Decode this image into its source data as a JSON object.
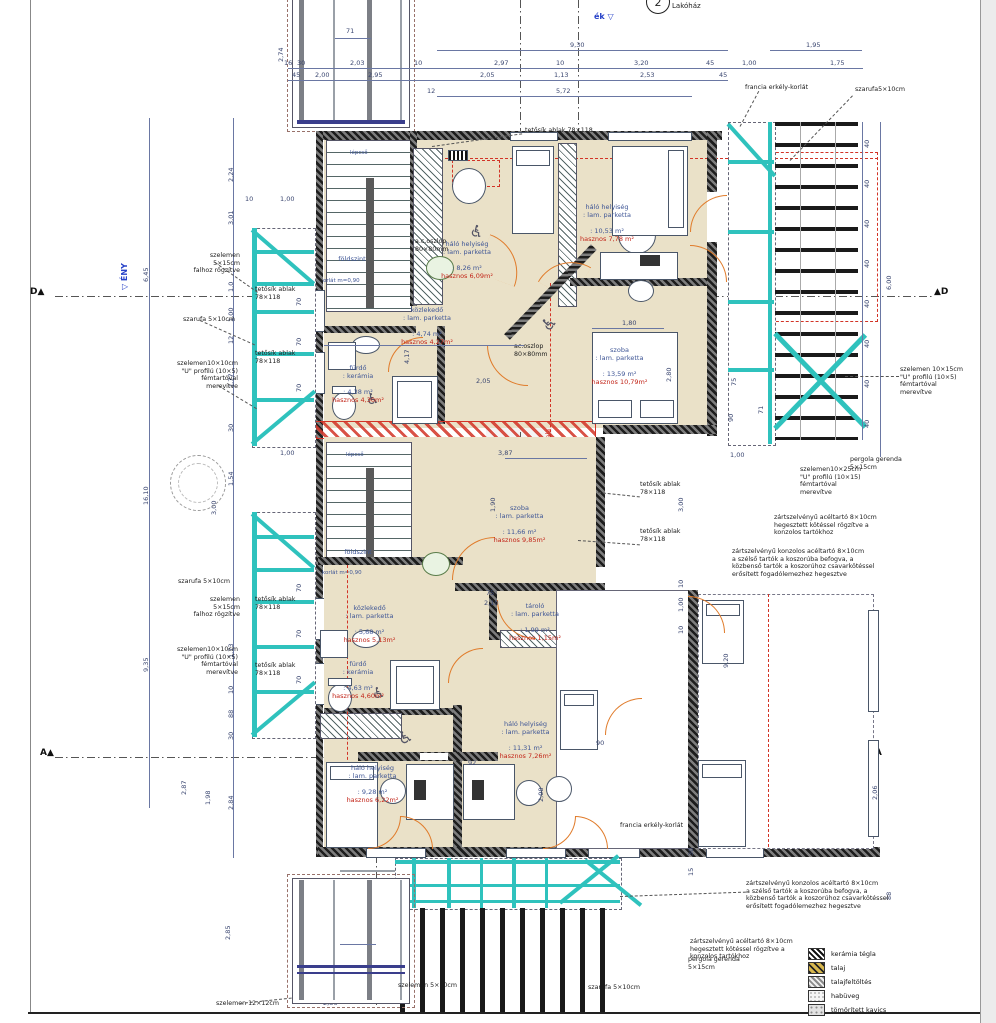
{
  "markers": {
    "unit1_num": "1",
    "unit1_label": "Lakóház",
    "unit2_num": "2",
    "unit2_label": "Lakóház",
    "dir_top": "ék",
    "dir_top_tri": "▽",
    "dir_left": "▽ ÉNY",
    "dir_right": "▽ DK",
    "north_letter": "É",
    "sec_d_left": "D▲",
    "sec_d_right": "▲D",
    "sec_a_left": "A▲",
    "sec_a_right": "▲A"
  },
  "rooms": [
    {
      "name": "háló helyiség",
      "floor": ": lam. parketta",
      "area": ": 8,26 m²",
      "useful": "hasznos 6,09m²"
    },
    {
      "name": "háló helyiség",
      "floor": ": lam. parketta",
      "area": ": 10,53 m²",
      "useful": "hasznos 7,78 m²"
    },
    {
      "name": "közlekedő",
      "floor": ": lam. parketta",
      "area": ": 4,74 m²",
      "useful": "hasznos 4,27m²"
    },
    {
      "name": "szoba",
      "floor": ": lam. parketta",
      "area": ": 13,59 m²",
      "useful": "hasznos 10,79m²"
    },
    {
      "name": "fürdő",
      "floor": ": kerámia",
      "area": ": 4,38 m²",
      "useful": "hasznos 4,30m²"
    },
    {
      "name": "szoba",
      "floor": ": lam. parketta",
      "area": ": 11,66 m²",
      "useful": "hasznos 9,85m²"
    },
    {
      "name": "közlekedő",
      "floor": ": lam. parketta",
      "area": ": 5,68 m²",
      "useful": "hasznos 5,13m²"
    },
    {
      "name": "tároló",
      "floor": ": lam. parketta",
      "area": ": 1,99 m²",
      "useful": "hasznos 1,15m²"
    },
    {
      "name": "fürdő",
      "floor": ": kerámia",
      "area": ": 4,63 m²",
      "useful": "hasznos 4,60m²"
    },
    {
      "name": "háló helyiség",
      "floor": ": lam. parketta",
      "area": ": 11,31 m²",
      "useful": "hasznos 7,26m²"
    },
    {
      "name": "háló helyiség",
      "floor": ": lam. parketta",
      "area": ": 9,28 m²",
      "useful": "hasznos 6,22m²"
    }
  ],
  "stairs": {
    "label": "lépcső",
    "floor_ref": "földszint",
    "rail": "korlát m=0,90"
  },
  "annotations": {
    "szelemen515": "szelemen\n5×15cm\nfalhoz rögzítve",
    "szarufa510": "szarufa 5×10cm",
    "szarufa510b": "szarufa5×10cm",
    "tetosik": "tetősík ablak\n78×118",
    "tetosik_inline": "tetősík ablak 78×118",
    "szelemen1010": "szelemen10×10cm\n\"U\" profilú (10×5)\nfémtartóval\nmerevítve",
    "szelemen1015": "szelemen 10×15cm\n\"U\" profilú (10×5)\nfémtartóval\nmerevítve",
    "szelemen1025": "szelemen10×25cm\n\"U\" profilú (10×15)\nfémtartóval\nmerevítve",
    "szelemen1212": "szelemen 12×12cm",
    "szelemen510": "szelemen 5×10cm",
    "francia": "francia erkély-korlát",
    "pergola": "pergola gerenda\n5×15cm",
    "zart_acel": "zártszelvényű acéltartó 8×10cm\nhegesztett kötéssel rögzítve a\nkonzolos tartókhoz",
    "zart_konzol": "zártszelvényű konzolos acéltartó 8×10cm\na szélső tartók a koszorúba befogva, a\nközbenső tartók a koszorúhoz csavarkötéssel\nerősített fogadólemezhez hegesztve",
    "acoszlop": "a.c.oszlop\n80×80mm",
    "acoszlop2": "ac.oszlop\n80×80mm",
    "belmag": "1,90 m belmagasság vonala"
  },
  "dims": {
    "forty": "40",
    "list": [
      "9,30",
      "1,95",
      "16",
      "30",
      "2,03",
      "10",
      "2,97",
      "10",
      "3,20",
      "45",
      "1,00",
      "1,75",
      "45",
      "2,00",
      "2,95",
      "12",
      "2,05",
      "1,13",
      "2,53",
      "45",
      "5,72",
      "71",
      "2,74",
      "2,24",
      "3,01",
      "6,45",
      "1,0",
      "1,00",
      "12",
      "1,77",
      "30",
      "4,74",
      "10",
      "1,00",
      "16,10",
      "3,00",
      "1,54",
      "1,00",
      "9,35",
      "1,73",
      "10",
      "88",
      "30",
      "2,87",
      "1,98",
      "2,84",
      "2,85",
      "2,74",
      "71",
      "2,36",
      "6,00",
      "75",
      "71",
      "90",
      "3,00",
      "10",
      "1,00",
      "10",
      "9,20",
      "30",
      "15",
      "88",
      "2,06",
      "90",
      "92",
      "2,08",
      "1,80",
      "2,80",
      "2,05",
      "4,17",
      "3,87",
      "1,90",
      "75",
      "2,10",
      "1,00",
      "60",
      "60",
      "70",
      "70",
      "70",
      "70",
      "70",
      "70"
    ]
  },
  "legend": {
    "items": [
      {
        "label": "kerámia tégla"
      },
      {
        "label": "talaj"
      },
      {
        "label": "talajfeltöltés"
      },
      {
        "label": "habüveg"
      },
      {
        "label": "tömörített kavics"
      }
    ]
  },
  "colors": {
    "teal": "#2fc2bd",
    "orange": "#e07b2a",
    "red": "#d23326",
    "beige": "#eae1c8",
    "dim_blue": "#3a4670"
  }
}
